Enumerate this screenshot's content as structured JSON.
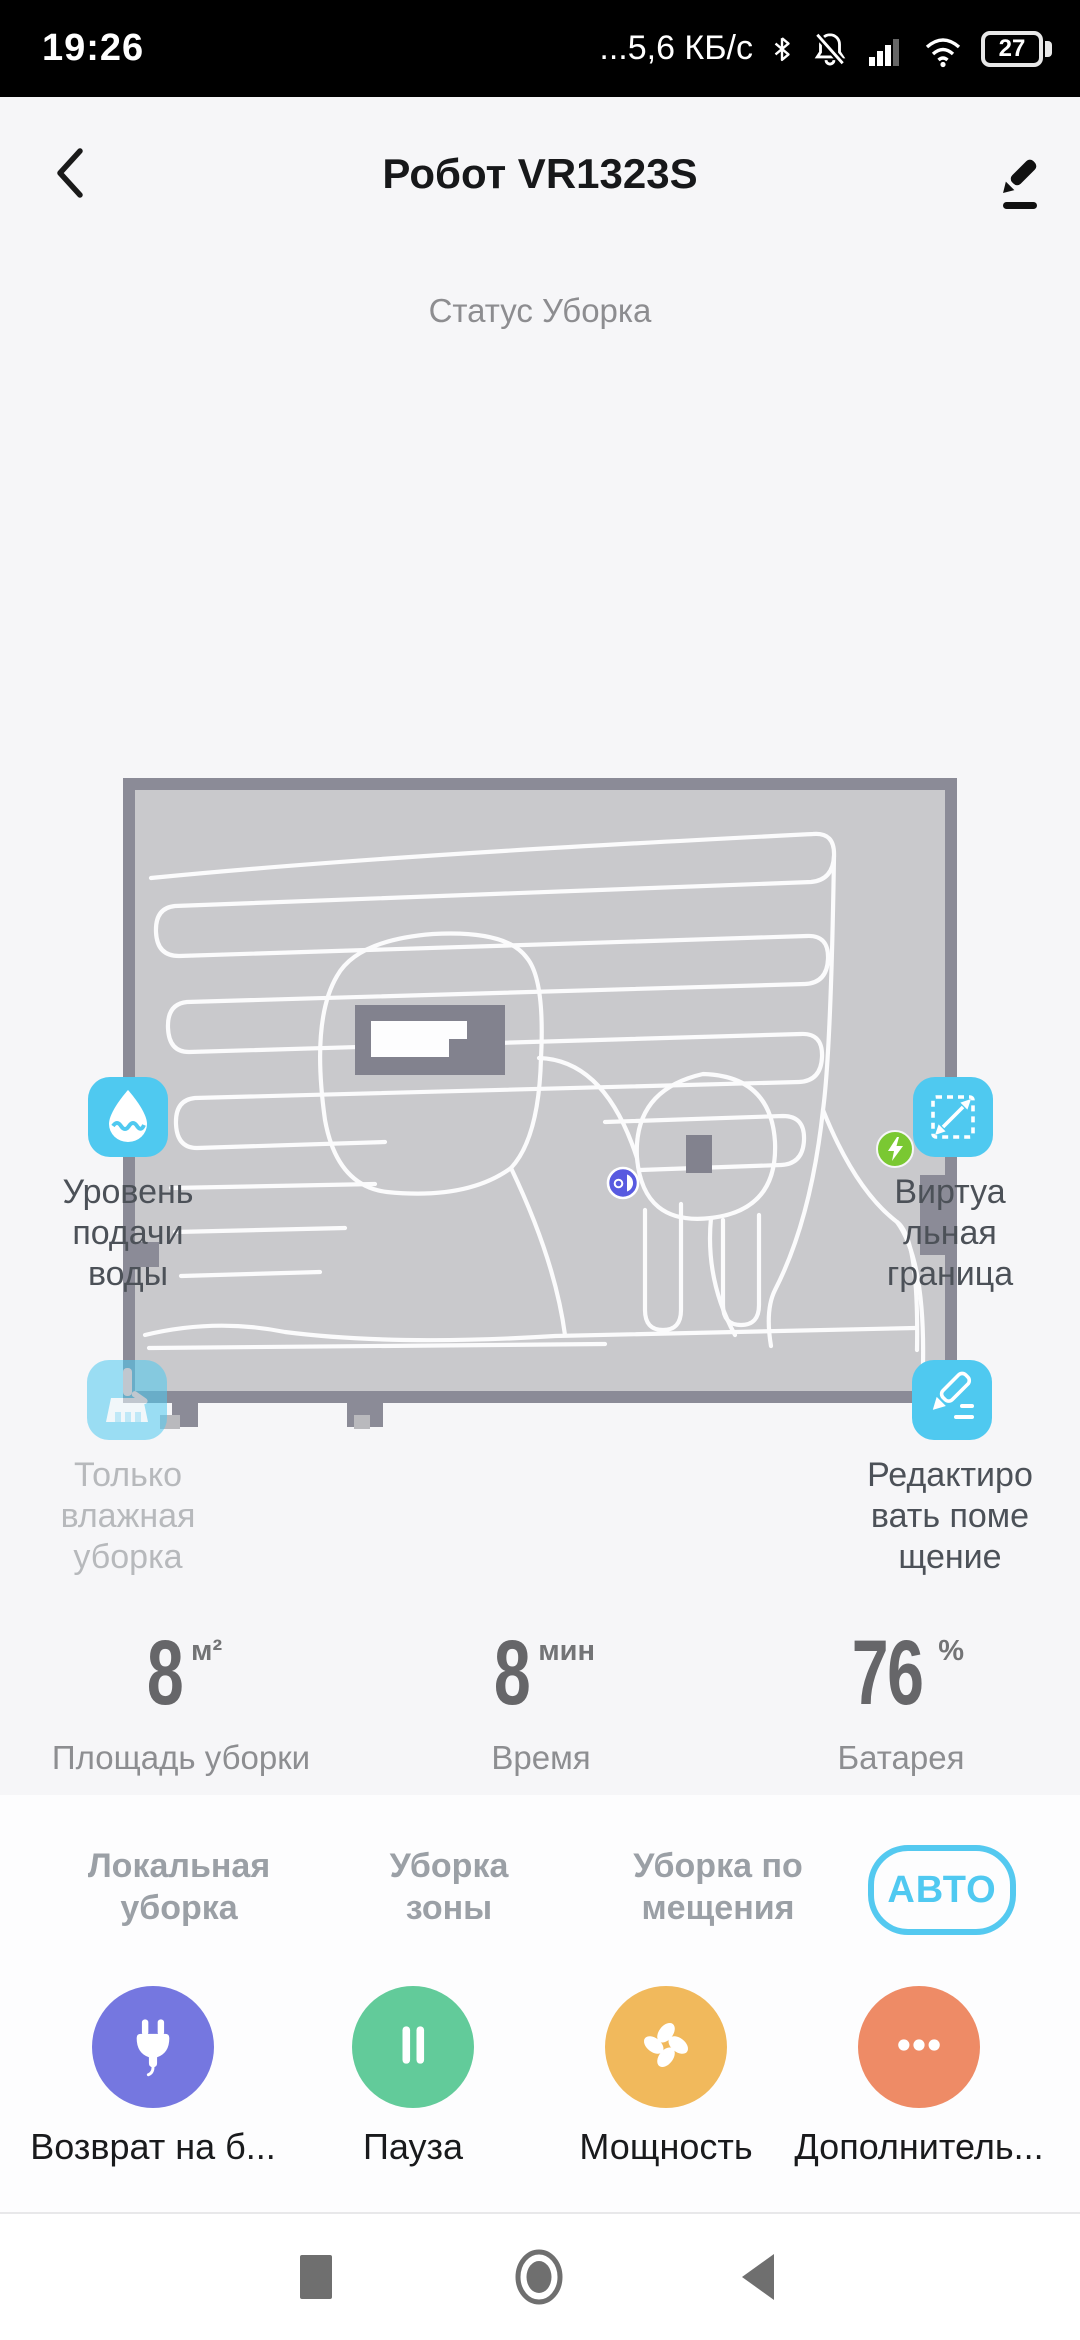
{
  "status_bar": {
    "time": "19:26",
    "network_speed": "...5,6 КБ/с",
    "battery_percent": "27",
    "icons": [
      "bluetooth-icon",
      "notifications-off-icon",
      "signal-icon",
      "wifi-icon",
      "battery-icon"
    ]
  },
  "header": {
    "title": "Робот VR1323S"
  },
  "status_line": "Статус Уборка",
  "features": {
    "water": {
      "label": "Уровень\nподачи\nводы"
    },
    "boundary": {
      "label": "Виртуа\nльная\nграница"
    },
    "mop_only": {
      "label": "Только\nвлажная\nуборка"
    },
    "edit_room": {
      "label": "Редактиро\nвать поме\nщение"
    }
  },
  "stats": [
    {
      "value": "8",
      "unit": "м²",
      "label": "Площадь уборки"
    },
    {
      "value": "8",
      "unit": "мин",
      "label": "Время"
    },
    {
      "value": "76",
      "unit": "%",
      "label": "Батарея"
    }
  ],
  "modes": [
    {
      "label": "Локальная\nуборка"
    },
    {
      "label": "Уборка\nзоны"
    },
    {
      "label": "Уборка по\nмещения"
    }
  ],
  "auto_button_label": "АВТО",
  "actions": [
    {
      "label": "Возврат на б...",
      "icon": "plug-icon",
      "color": "#7577e0"
    },
    {
      "label": "Пауза",
      "icon": "pause-icon",
      "color": "#62cb9a"
    },
    {
      "label": "Мощность",
      "icon": "fan-icon",
      "color": "#f1b95c"
    },
    {
      "label": "Дополнитель...",
      "icon": "more-dots-icon",
      "color": "#ee8b66"
    }
  ],
  "colors": {
    "accent_cyan": "#4fc9f0",
    "badge_green": "#7ac832",
    "robot_purple": "#585ae0",
    "map_fill": "#c9c9cc",
    "map_border": "#8b8b97"
  }
}
